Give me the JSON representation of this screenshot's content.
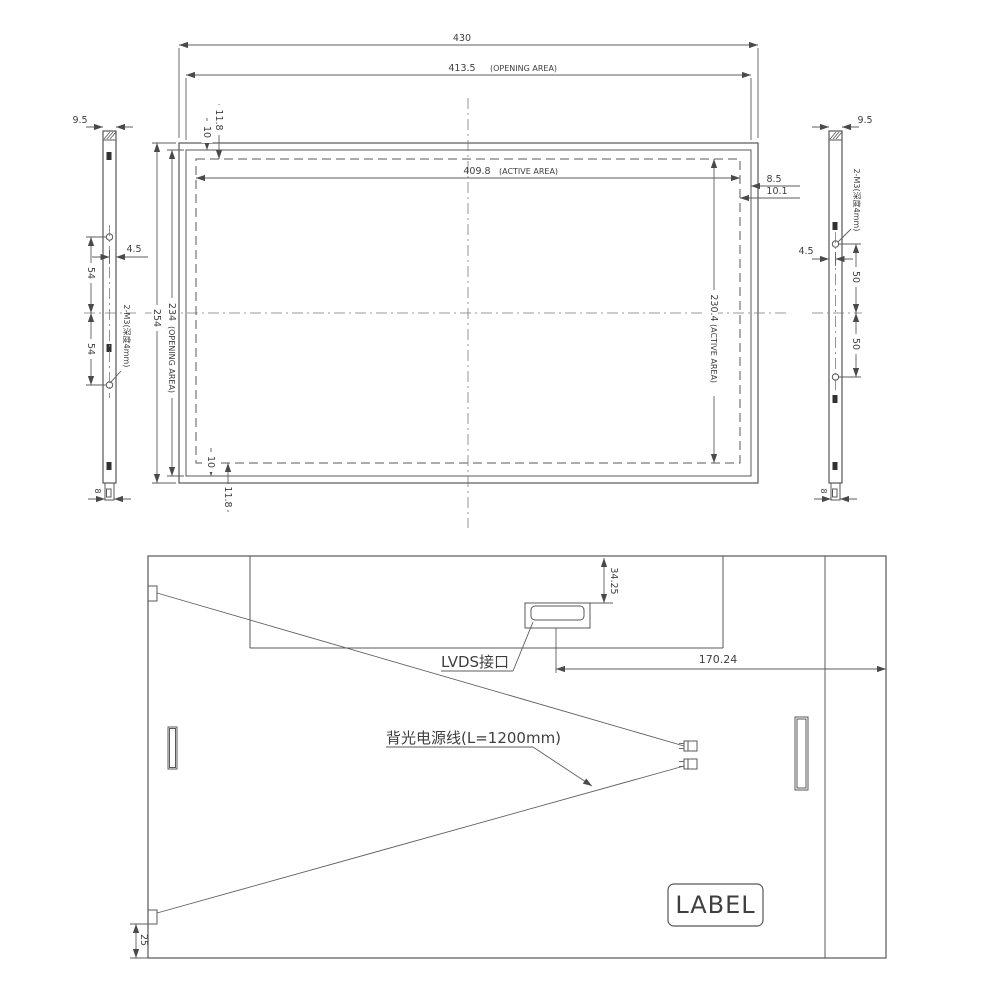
{
  "front_view": {
    "dim_overall_width": "430",
    "dim_opening_width": "413.5",
    "opening_suffix": "(OPENING AREA)",
    "dim_active_width": "409.8",
    "active_suffix": "(ACTIVE AREA)",
    "dim_edge_to_opening_right": "8.5",
    "dim_edge_to_active_right": "10.1",
    "dim_edge_to_active_top": "11.8",
    "dim_edge_to_opening_top": "10",
    "dim_overall_height": "254",
    "dim_opening_height": "234",
    "dim_active_height": "230.4",
    "dim_edge_to_opening_bottom": "10",
    "dim_edge_to_active_bottom": "11.8"
  },
  "left_side_view": {
    "dim_thickness": "9.5",
    "dim_hole_offset": "4.5",
    "dim_hole_pitch_upper": "54",
    "dim_hole_pitch_lower": "54",
    "dim_bottom_tab": "8",
    "screw_note": "2-M3(深度4mm)"
  },
  "right_side_view": {
    "dim_thickness": "9.5",
    "dim_hole_offset": "4.5",
    "dim_hole_pitch_upper": "50",
    "dim_hole_pitch_lower": "50",
    "dim_bottom_tab": "8",
    "screw_note": "2-M3(深度4mm)"
  },
  "rear_view": {
    "dim_connector_from_top": "34.25",
    "lvds_label": "LVDS接口",
    "dim_connector_to_edge": "170.24",
    "backlight_label": "背光电源线(L=1200mm)",
    "label_box": "LABEL",
    "dim_clip_from_bottom": "25"
  }
}
